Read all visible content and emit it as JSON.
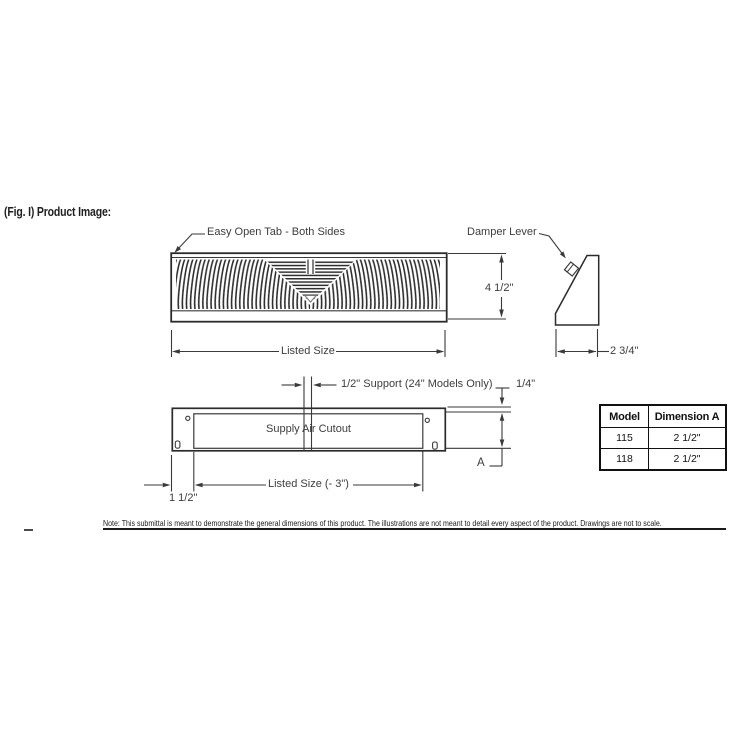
{
  "figure": {
    "title": "(Fig. I) Product Image:"
  },
  "labels": {
    "easy_open_tab": "Easy Open Tab - Both Sides",
    "damper_lever": "Damper Lever",
    "dim_height": "4 1/2\"",
    "listed_size": "Listed Size",
    "dim_depth": "2 3/4\"",
    "support": "1/2\" Support (24\" Models Only)",
    "dim_quarter": "1/4\"",
    "supply_air_cutout": "Supply Air Cutout",
    "dim_a": "A",
    "listed_size_minus": "Listed Size (- 3\")",
    "dim_side": "1 1/2\""
  },
  "table": {
    "headers": [
      "Model",
      "Dimension A"
    ],
    "rows": [
      [
        "115",
        "2 1/2\""
      ],
      [
        "118",
        "2 1/2\""
      ]
    ]
  },
  "note": "Note: This submittal is meant to demonstrate the general dimensions of this product. The illustrations are not meant to detail every aspect of the product. Drawings are not to scale.",
  "colors": {
    "line": "#3a3a3a",
    "rect_line": "#2b2b2b",
    "text": "#3d3d3d"
  }
}
